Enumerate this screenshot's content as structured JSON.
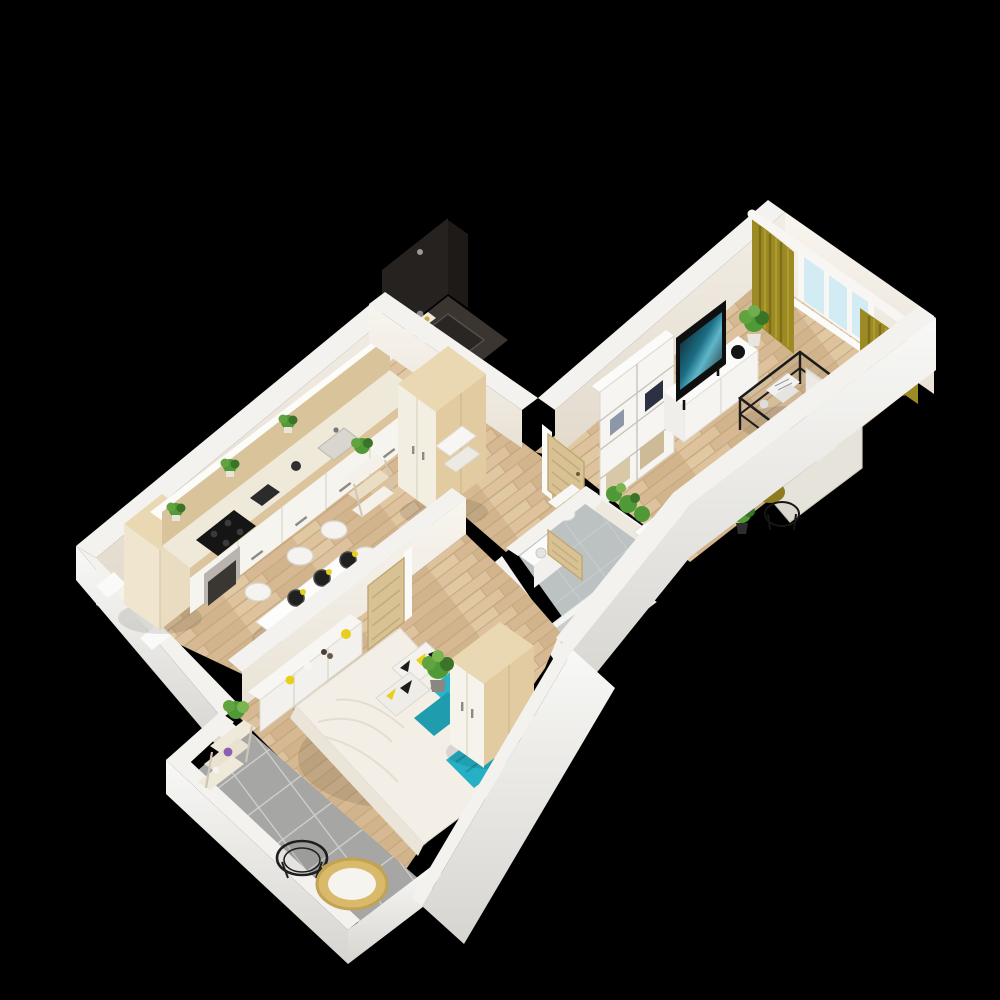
{
  "meta": {
    "title": "3D isometric floor plan of a one-bedroom apartment",
    "type": "architectural-3d-render",
    "visible_text": "none"
  },
  "palette": {
    "background": "#000000",
    "wallCap": "#f3f2ef",
    "wallFaceTop": "#f2ede5",
    "wallFaceBottom": "#e2dacc",
    "wallOuterTop": "#f8f8f6",
    "wallOuterBottom": "#d7d5d0",
    "floorWood": "#d9bd97",
    "floorWoodGap": "#c6a87f",
    "floorTile": "#a6a6a4",
    "tileGrout": "#d2d2d0",
    "bathFloor": "#bcc2c2",
    "showerDark": "#26221f",
    "doorTan": "#d8c294",
    "doorTanEdge": "#bfa671",
    "furnWood": "#e2cba1",
    "furnWoodLight": "#ead8b2",
    "white": "#f7f6f2",
    "sofa": "#e6e3da",
    "olive": "#9c8a24",
    "oliveDark": "#7a6a16",
    "teal": "#28b5c9",
    "tealDark": "#1f9cae",
    "yellow": "#e7cf1d",
    "green": "#4f9a36",
    "greenDark": "#3a7427",
    "black": "#1c1c1c",
    "windowGlass": "#d3ecf4"
  },
  "scene": {
    "rooms": [
      {
        "id": "kitchen-dining",
        "label": "Kitchen / Dining",
        "furniture": [
          "tall-cabinet",
          "kitchen-counter",
          "cooktop",
          "oven",
          "coffee-machine",
          "sink",
          "counter-plants",
          "dining-table",
          "dining-chairs",
          "place-settings",
          "shelf-unit"
        ]
      },
      {
        "id": "hallway",
        "label": "Hallway",
        "furniture": [
          "hall-wardrobe",
          "entry-shelf",
          "step-stools"
        ]
      },
      {
        "id": "shower-room",
        "label": "Shower Room",
        "furniture": [
          "walk-in-shower",
          "shower-tray",
          "shower-shelf"
        ]
      },
      {
        "id": "bathroom",
        "label": "Bathroom",
        "furniture": [
          "bathtub",
          "toilet",
          "washbasin",
          "wall-planter",
          "bathroom-door",
          "desk",
          "desk-chair"
        ]
      },
      {
        "id": "living-room",
        "label": "Living Room",
        "furniture": [
          "bookshelf",
          "tv-stand",
          "tv",
          "plant",
          "coffee-table",
          "corner-sofa",
          "olive-pillows",
          "tablet",
          "pouf",
          "side-table",
          "floor-plant",
          "curtains",
          "window",
          "curtain-rod",
          "interior-door"
        ]
      },
      {
        "id": "bedroom",
        "label": "Bedroom",
        "furniture": [
          "double-bed",
          "duvet",
          "patterned-pillows",
          "teal-pillows",
          "teal-throw",
          "wardrobe",
          "sideboard",
          "decor-vases",
          "plant",
          "bedroom-door"
        ]
      },
      {
        "id": "balcony",
        "label": "Balcony",
        "furniture": [
          "plant-etagere",
          "wire-table",
          "rattan-chair",
          "railing"
        ]
      }
    ]
  }
}
